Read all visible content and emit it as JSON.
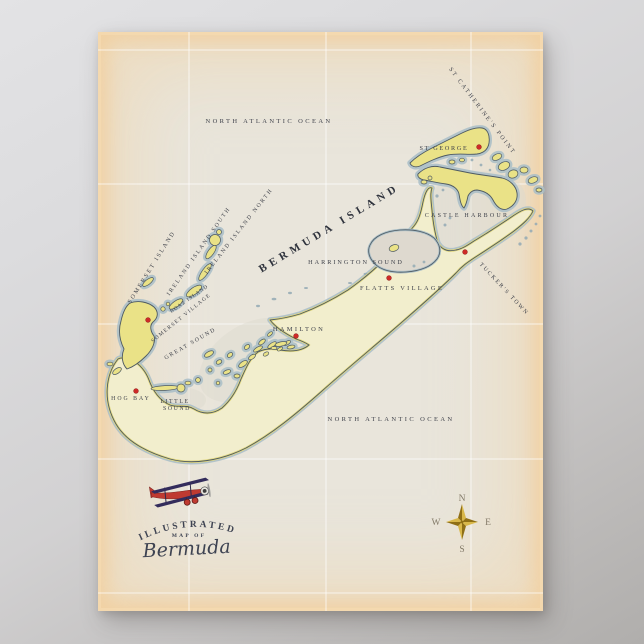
{
  "poster": {
    "title_line1": "ILLUSTRATED",
    "title_line2": "MAP OF",
    "title_line3": "Bermuda"
  },
  "map": {
    "island_title": "BERMUDA ISLAND",
    "ocean_top": "NORTH ATLANTIC OCEAN",
    "ocean_bottom": "NORTH ATLANTIC OCEAN",
    "places": {
      "st_catherines_point": "ST CATHERINE'S POINT",
      "st_george": "ST GEORGE",
      "castle_harbour": "CASTLE HARBOUR",
      "harrington_sound": "HARRINGTON SOUND",
      "tuckers_town": "TUCKER'S TOWN",
      "flatts_village": "FLATTS VILLAGE",
      "hamilton": "HAMILTON",
      "somerset_island": "SOMERSET ISLAND",
      "ireland_island_south": "IRELAND ISLAND SOUTH",
      "ireland_island_north": "IRELAND ISLAND NORTH",
      "boaz_island": "BOAZ ISLAND",
      "somerset_village": "SOMERSET VILLAGE",
      "great_sound": "GREAT SOUND",
      "hog_bay": "HOG BAY",
      "little_sound_line1": "LITTLE",
      "little_sound_line2": "SOUND"
    },
    "compass": {
      "north": "N",
      "east": "E",
      "south": "S",
      "west": "W"
    }
  },
  "colors": {
    "paper": "#e9e5db",
    "land_cream": "#f2eecd",
    "land_yellow": "#eae287",
    "land_rim": "#e2d87e",
    "coast_halo": "#a9bec7",
    "coast_line": "#4e5a62",
    "reef_gray": "#93aab4",
    "water_tint": "#ded9cf",
    "grid_line": "#ffffff",
    "marker_red": "#ce2a27",
    "ink": "#3c3f48",
    "title_ink": "#3e4352",
    "compass_gold_light": "#d8b74a",
    "compass_gold_dark": "#8f6f16",
    "compass_letter": "#837a68",
    "plane_red": "#bf3a31",
    "plane_navy": "#332c5c"
  }
}
